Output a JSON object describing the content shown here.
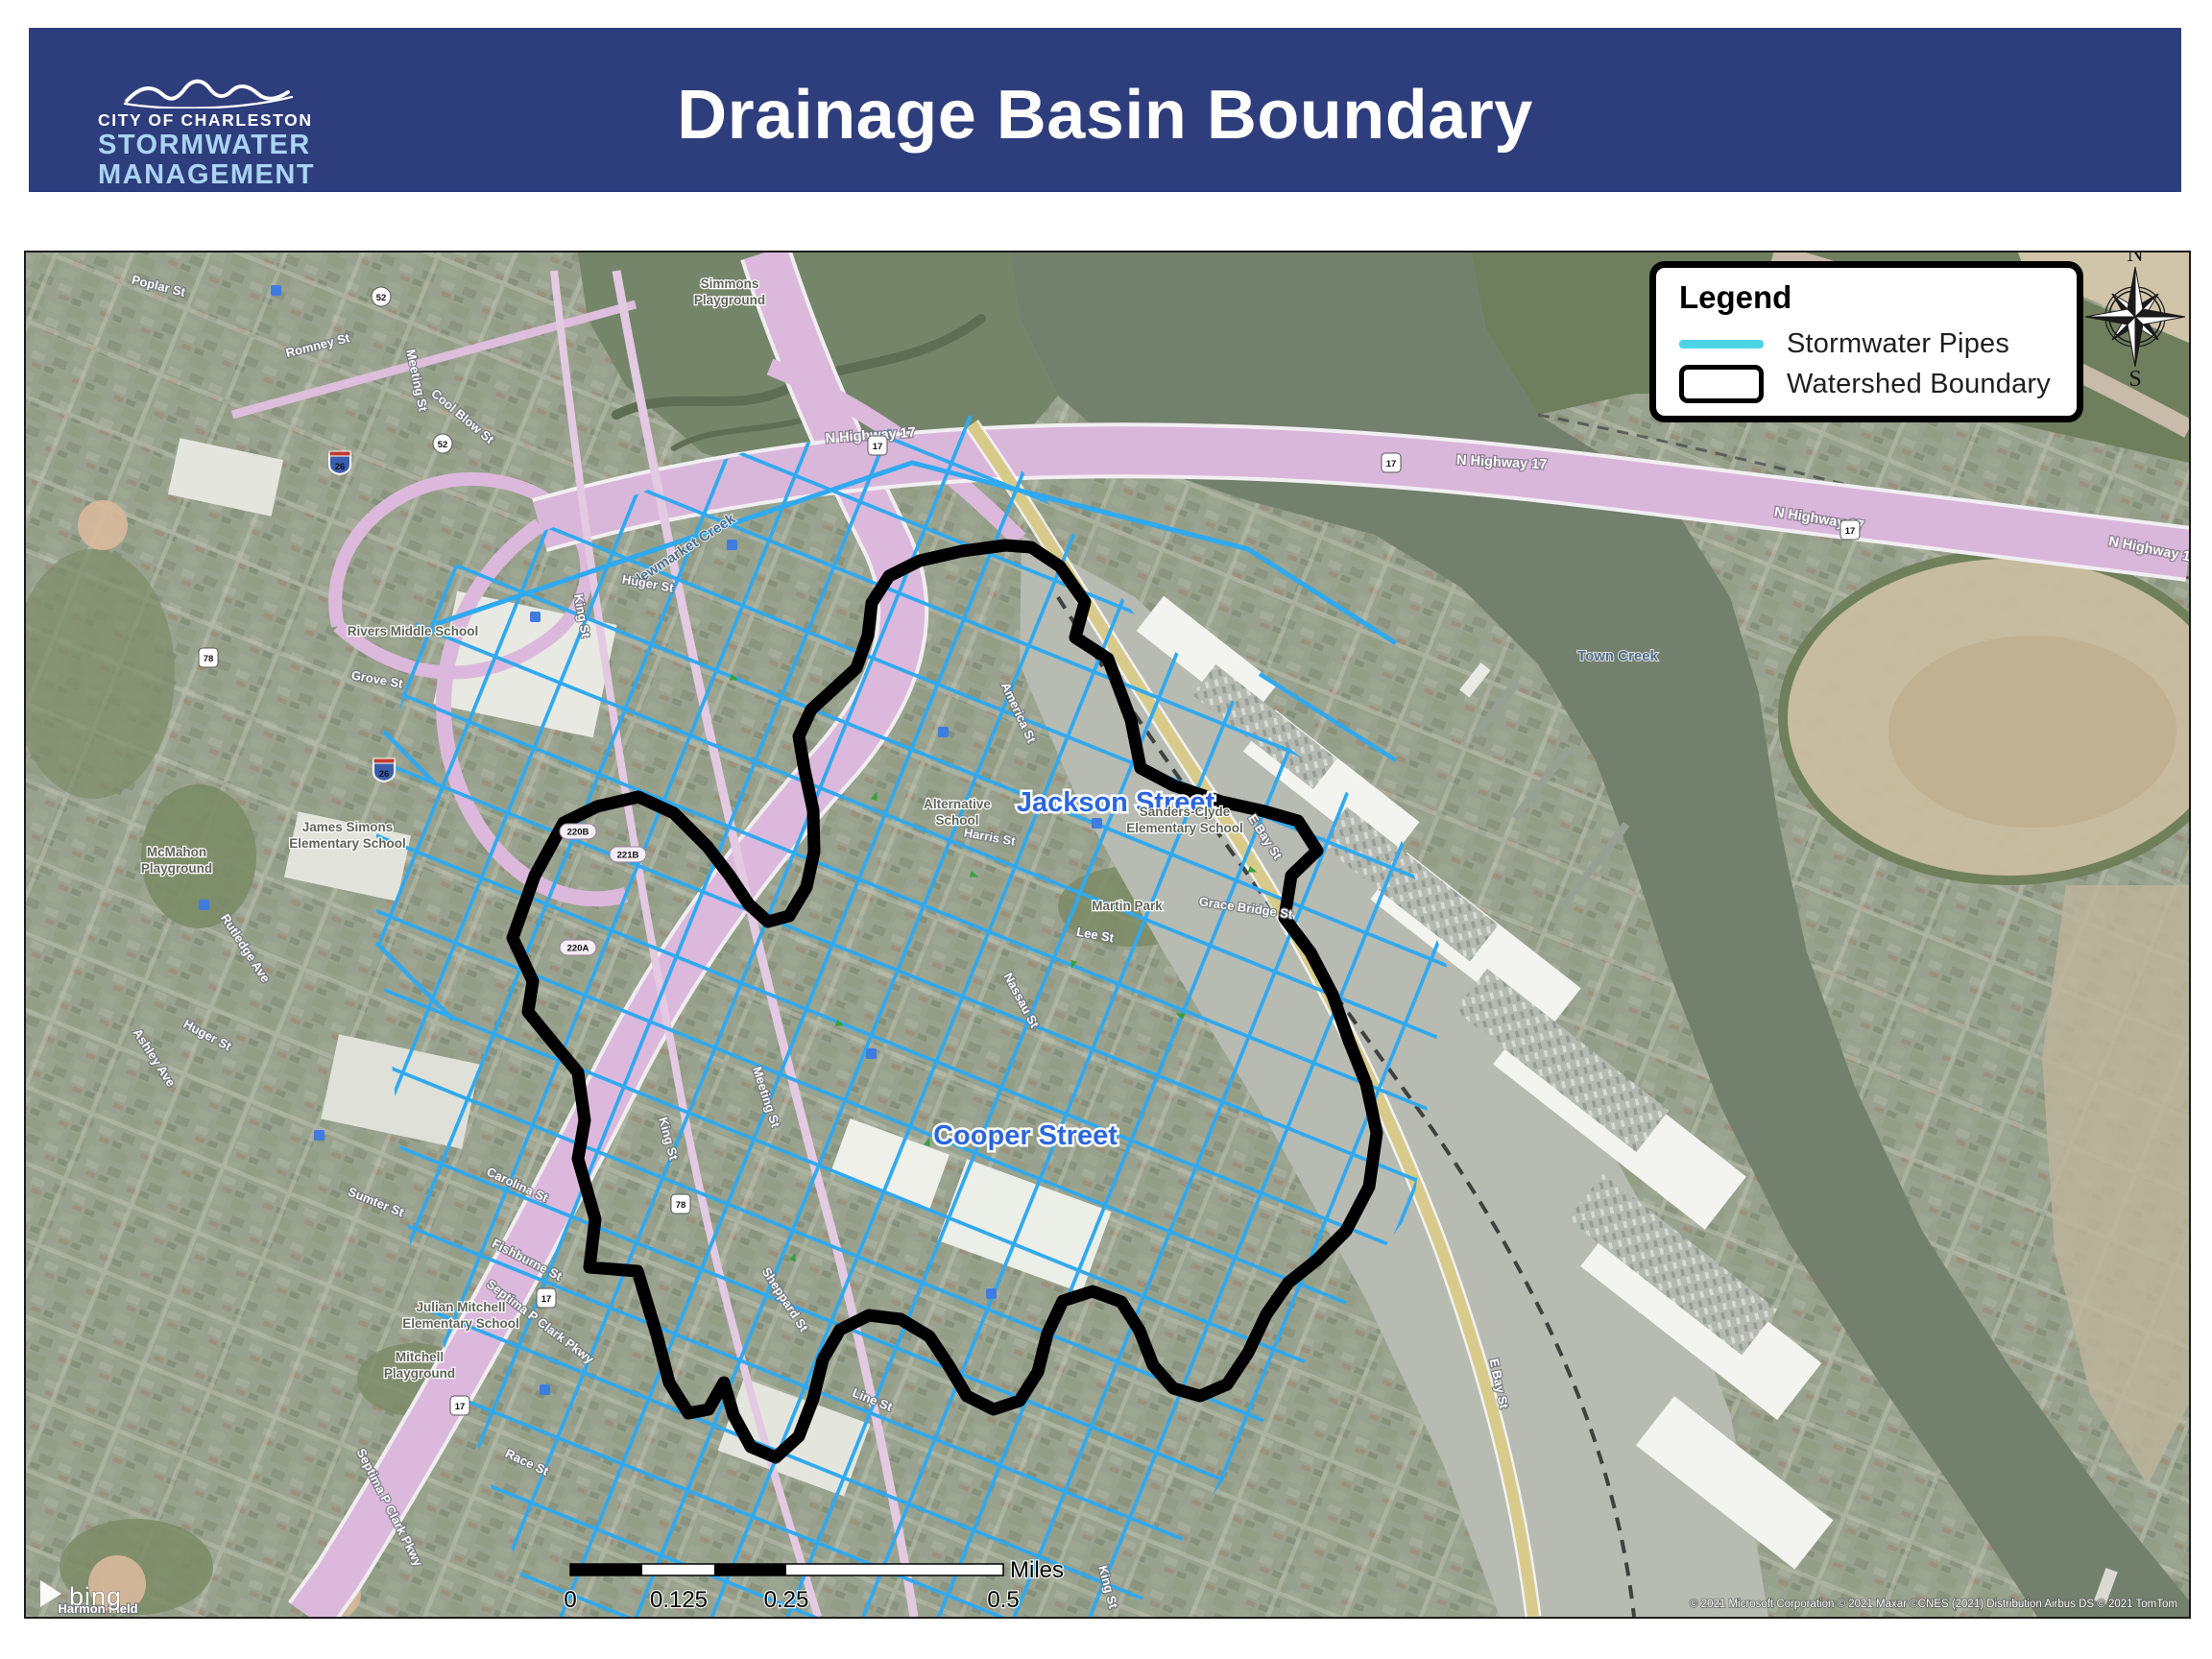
{
  "header": {
    "bg_color": "#2e3d7c",
    "title": "Drainage Basin Boundary",
    "logo": {
      "org": "CITY OF CHARLESTON",
      "dept_line1": "STORMWATER",
      "dept_line2": "MANAGEMENT",
      "accent_color": "#a9d4f2"
    }
  },
  "legend": {
    "title": "Legend",
    "items": [
      {
        "label": "Stormwater Pipes"
      },
      {
        "label": "Watershed Boundary"
      }
    ],
    "pipe_swatch_color": "#4dd3e6"
  },
  "compass": {
    "n": "N",
    "e": "E",
    "s": "S",
    "w": "W"
  },
  "scale_bar": {
    "ticks": [
      "0",
      "0.125",
      "0.25",
      "0.5"
    ],
    "unit": "Miles"
  },
  "map": {
    "provider_logo": "bing",
    "attribution": "© 2021 Microsoft Corporation © 2021 Maxar ©CNES (2021) Distribution Airbus DS © 2021 TomTom",
    "colors": {
      "pipes": "#2fa9f0",
      "boundary": "#000000",
      "water": "#73806d",
      "highway": "#d9b7da",
      "yellow_road": "#d8ca8a",
      "street_label_blue": "#2b66e0"
    },
    "labels": {
      "jackson_street": "Jackson Street",
      "cooper_street": "Cooper Street",
      "town_creek": "Town Creek",
      "newmarket_creek": "Newmarket Creek",
      "n_highway_17": "N Highway 17",
      "e_bay_st": "E Bay St",
      "septima_p_clark_pkwy": "Septima P Clark Pkwy",
      "king_st": "King St",
      "meeting_st": "Meeting St",
      "romney_st": "Romney St",
      "rutledge_ave": "Rutledge Ave",
      "ashley_ave": "Ashley Ave",
      "huger_st": "Huger St",
      "harris_st": "Harris St",
      "grace_bridge_st": "Grace Bridge St",
      "lee_st": "Lee St",
      "line_st": "Line St",
      "sumter_st": "Sumter St",
      "fishburne_st": "Fishburne St",
      "carolina_st": "Carolina St",
      "race_st": "Race St",
      "grove_st": "Grove St",
      "poplar_st": "Poplar St",
      "cool_blow_st": "Cool Blow St",
      "nassau_st": "Nassau St",
      "america_st": "America St",
      "sheppard_st": "Sheppard St"
    },
    "places": {
      "mcmahon": [
        "McMahon",
        "Playground"
      ],
      "simmons": [
        "Simmons",
        "Playground"
      ],
      "rivers": "Rivers Middle School",
      "james_simons": [
        "James Simons",
        "Elementary School"
      ],
      "sanders_clyde": [
        "Sanders-Clyde",
        "Elementary School"
      ],
      "julian_mitchell": [
        "Julian Mitchell",
        "Elementary School"
      ],
      "mitchell_playground": [
        "Mitchell",
        "Playground"
      ],
      "martin_park": "Martin Park",
      "alternative_school": [
        "Alternative",
        "School"
      ],
      "harmon_field": "Harmon Field"
    },
    "shields": {
      "i26": "26",
      "us17": "17",
      "us78": "78",
      "sc52": "52",
      "r220a": "220A",
      "r220b": "220B",
      "r221b": "221B"
    }
  }
}
